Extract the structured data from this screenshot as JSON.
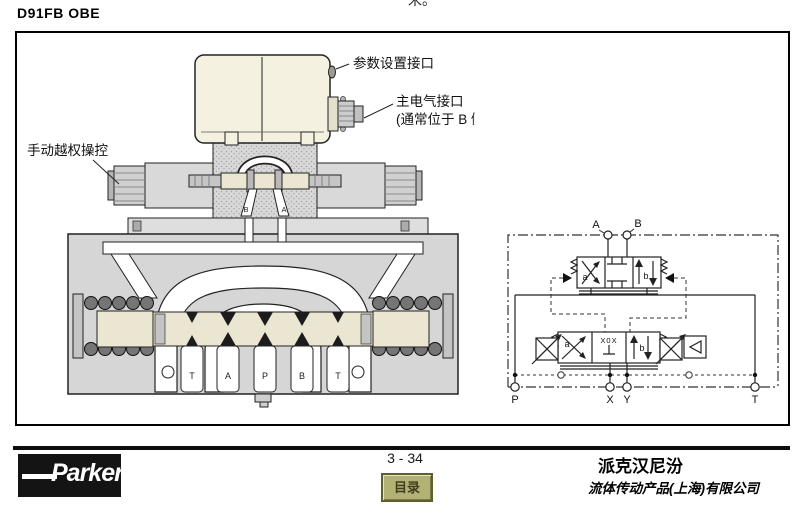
{
  "page": {
    "clipped_top_text": "米。",
    "title": "D91FB OBE"
  },
  "figure": {
    "callouts": {
      "param_port": "参数设置接口",
      "main_conn_line1": "主电气接口",
      "main_conn_line2": "(通常位于 B 侧)",
      "manual_override": "手动越权操控"
    },
    "pilot_port_labels": [
      "B",
      "A"
    ],
    "body_port_labels": [
      "T",
      "A",
      "P",
      "B",
      "T"
    ]
  },
  "schematic": {
    "top_port_labels": [
      "A",
      "B"
    ],
    "bottom_port_labels": [
      "P",
      "X",
      "Y",
      "T"
    ],
    "main_stage_positions": [
      "a",
      "b"
    ],
    "pilot_stage_positions": [
      "a",
      "b"
    ],
    "pilot_center_code": "X0X"
  },
  "footer": {
    "logo": "Parker",
    "page_number": "3 - 34",
    "toc_button": "目录",
    "brand_cn": "派克汉尼汾",
    "company_cn": "流体传动产品(上海)有限公司"
  },
  "colors": {
    "housing_beige": "#f4f1e1",
    "body_gray": "#d6d6d6",
    "spool_cream": "#eae6d2",
    "toc_olive": "#b2b274"
  }
}
